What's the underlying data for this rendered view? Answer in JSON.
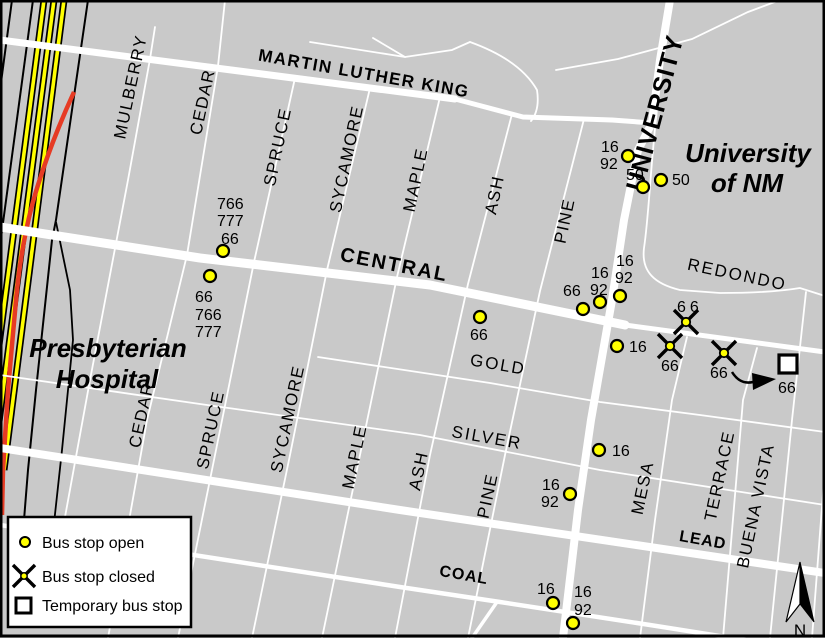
{
  "colors": {
    "background": "#c9c9c9",
    "road": "#ffffff",
    "railroad": "#ffff00",
    "detour_line": "#e63b24",
    "stop_open_fill": "#ffff00"
  },
  "legend": {
    "items": [
      {
        "id": "open",
        "label": "Bus stop open"
      },
      {
        "id": "closed",
        "label": "Bus stop closed"
      },
      {
        "id": "temporary",
        "label": "Temporary bus stop"
      }
    ]
  },
  "landmarks": {
    "hospital": {
      "line1": "Presbyterian",
      "line2": "Hospital"
    },
    "university": {
      "line1": "University",
      "line2": "of NM"
    }
  },
  "streets": {
    "martin_luther_king": "MARTIN LUTHER KING",
    "central": "CENTRAL",
    "redondo": "REDONDO",
    "gold": "GOLD",
    "silver": "SILVER",
    "lead": "LEAD",
    "coal": "COAL",
    "mulberry": "MULBERRY",
    "cedar": "CEDAR",
    "spruce": "SPRUCE",
    "sycamore": "SYCAMORE",
    "maple": "MAPLE",
    "ash": "ASH",
    "pine": "PINE",
    "university": "UNIVERSITY",
    "mesa": "MESA",
    "terrace": "TERRACE",
    "buena_vista": "BUENA VISTA"
  },
  "stops": {
    "open": [
      {
        "id": "central-cedar-eastbound",
        "routes": [
          "766",
          "777",
          "66"
        ]
      },
      {
        "id": "central-cedar-westbound",
        "routes": [
          "66",
          "766",
          "777"
        ]
      },
      {
        "id": "central-sycamore",
        "routes": [
          "66"
        ]
      },
      {
        "id": "central-pine-west",
        "routes": [
          "66"
        ]
      },
      {
        "id": "central-pine-east",
        "routes": [
          "16",
          "92"
        ]
      },
      {
        "id": "central-university",
        "routes": [
          "16",
          "92"
        ]
      },
      {
        "id": "gold-university",
        "routes": [
          "16"
        ]
      },
      {
        "id": "university-mlk",
        "routes": [
          "16",
          "92"
        ]
      },
      {
        "id": "university-campus-west",
        "routes": [
          "50"
        ]
      },
      {
        "id": "university-campus-east",
        "routes": [
          "50"
        ]
      },
      {
        "id": "silver-university-north",
        "routes": [
          "16"
        ]
      },
      {
        "id": "silver-university-south",
        "routes": [
          "16",
          "92"
        ]
      },
      {
        "id": "coal-university-west",
        "routes": [
          "16"
        ]
      },
      {
        "id": "coal-university-east",
        "routes": [
          "16",
          "92"
        ]
      }
    ],
    "closed": [
      {
        "id": "central-mesa-north",
        "routes": [
          "66"
        ]
      },
      {
        "id": "central-mesa-south",
        "routes": [
          "66"
        ]
      },
      {
        "id": "central-terrace",
        "routes": [
          "66"
        ]
      }
    ],
    "temporary": [
      {
        "id": "central-buena-vista",
        "routes": [
          "66"
        ]
      }
    ]
  },
  "compass": {
    "label": "N"
  }
}
